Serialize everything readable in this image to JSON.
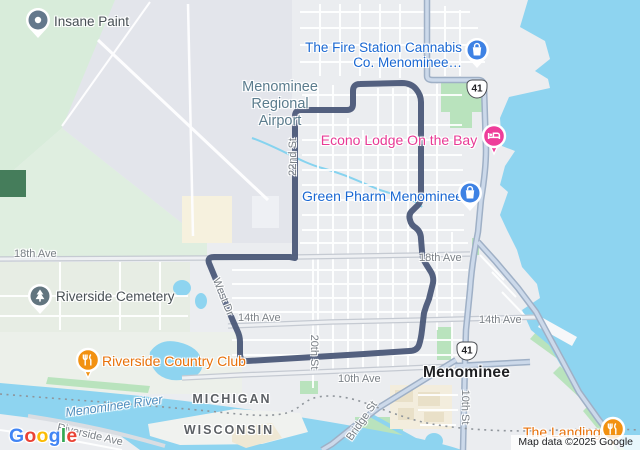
{
  "colors": {
    "water": "#8ed4f0",
    "land": "#ebedf0",
    "vegetation": "#d8ecda",
    "park": "#b9e3bd",
    "airport": "#e3e5eb",
    "route": "#4b5878",
    "road_major_blue": "#ccd9ea",
    "pin_blue": "#3e82e4",
    "text_blue": "#1967d2",
    "pin_pink": "#ee3d9a",
    "text_pink": "#e83a95",
    "pin_orange": "#f29111",
    "text_orange": "#e8710a",
    "pin_gray": "#64788c",
    "text_gray": "#474f54"
  },
  "pois": {
    "insane_paint": {
      "label": "Insane Paint",
      "type": "generic"
    },
    "fire_station": {
      "line1": "The Fire Station Cannabis",
      "line2": "Co. Menominee…",
      "type": "shopping"
    },
    "econo_lodge": {
      "label": "Econo Lodge On the Bay",
      "type": "hotel"
    },
    "green_pharm": {
      "label": "Green Pharm Menominee",
      "type": "shopping"
    },
    "riverside_cemetery": {
      "label": "Riverside Cemetery",
      "type": "cemetery"
    },
    "riverside_country_club": {
      "label": "Riverside Country Club",
      "type": "restaurant"
    },
    "the_landing": {
      "label": "The Landing",
      "type": "restaurant"
    }
  },
  "area_labels": {
    "airport": {
      "line1": "Menominee",
      "line2": "Regional",
      "line3": "Airport"
    }
  },
  "city_labels": {
    "menominee": "Menominee",
    "michigan": "MICHIGAN",
    "wisconsin": "WISCONSIN"
  },
  "road_labels": {
    "ave18_left": "18th Ave",
    "ave18_right": "18th Ave",
    "ave14_left": "14th Ave",
    "ave14_right": "14th Ave",
    "ave10": "10th Ave",
    "st22": "22nd St",
    "st20": "20th St",
    "st10": "10th St",
    "bridge_st": "Bridge St",
    "west_dr": "West Dr",
    "riverside_ave": "Riverside Ave"
  },
  "water_labels": {
    "river": "Menominee River"
  },
  "shields": {
    "us41": "41"
  },
  "attribution": "Map data ©2025 Google",
  "logo": {
    "text": "Google",
    "letters": [
      {
        "ch": "G",
        "color": "#4285F4"
      },
      {
        "ch": "o",
        "color": "#EA4335"
      },
      {
        "ch": "o",
        "color": "#FBBC05"
      },
      {
        "ch": "g",
        "color": "#4285F4"
      },
      {
        "ch": "l",
        "color": "#34A853"
      },
      {
        "ch": "e",
        "color": "#EA4335"
      }
    ]
  }
}
